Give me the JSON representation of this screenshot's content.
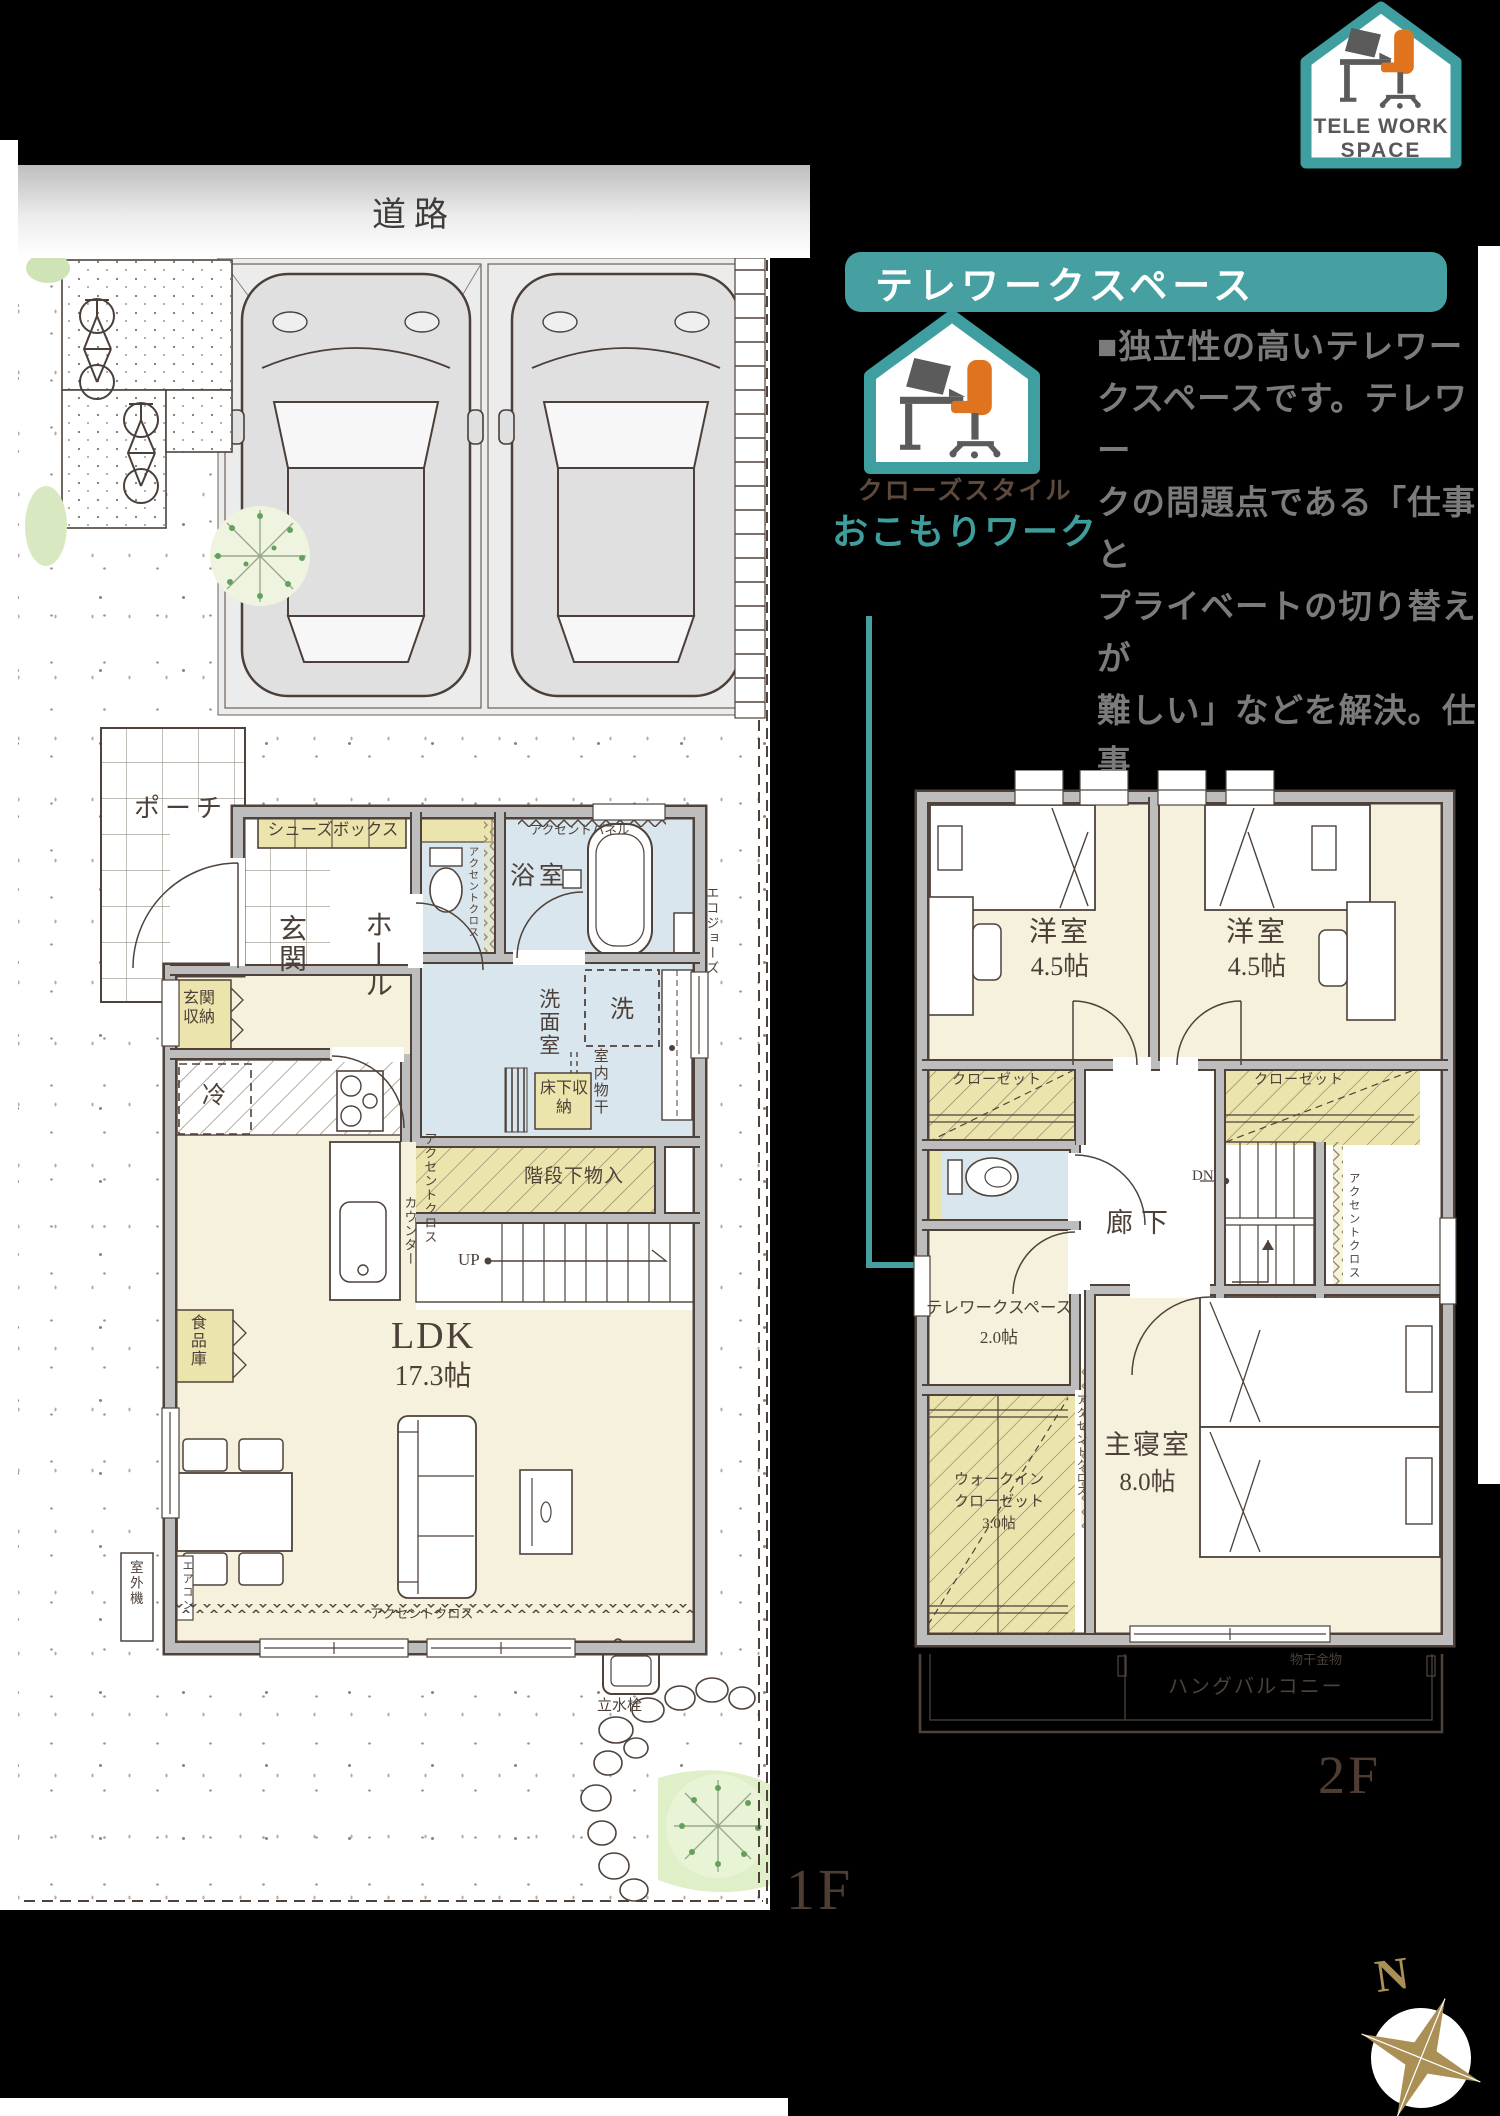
{
  "logo_badge": {
    "line1": "TELE WORK",
    "line2": "SPACE"
  },
  "road": {
    "label": "道路"
  },
  "feature": {
    "banner_title": "テレワークスペース",
    "style_tag": "クローズスタイル",
    "style_name": "おこもりワーク",
    "description": "■独立性の高いテレワー\nクスペースです。テレワー\nクの問題点である「仕事と\nプライベートの切り替えが\n難しい」などを解決。仕事\nにじっくり取り組めます。"
  },
  "floor1": {
    "floor_label": "1F",
    "labels": {
      "porch": "ポーチ",
      "shoes_box": "シューズボックス",
      "entrance": "玄関",
      "hall": "ホール",
      "entrance_storage": "玄関収納",
      "accent_cloth_toilet": "アクセントクロス",
      "bathroom": "浴室",
      "accent_panel": "アクセントパネル",
      "washroom": "洗面室",
      "washer": "洗",
      "indoor_drying": "室内物干",
      "underfloor_storage": "床下収納",
      "fridge": "冷",
      "accent_cloth_kitchen": "アクセントクロス",
      "counter": "カウンター",
      "under_stairs_storage": "階段下物入",
      "up": "UP",
      "ldk_name": "LDK",
      "ldk_size": "17.3帖",
      "pantry": "食品庫",
      "aircon": "エアコン",
      "outdoor_unit": "室外機",
      "accent_cloth_living": "アクセントクロス",
      "water_tap": "立水栓",
      "eco_jozu": "エコジョーズ"
    }
  },
  "floor2": {
    "floor_label": "2F",
    "labels": {
      "bedroom_left_name": "洋室",
      "bedroom_left_size": "4.5帖",
      "bedroom_right_name": "洋室",
      "bedroom_right_size": "4.5帖",
      "closet_left": "クローゼット",
      "closet_right": "クローゼット",
      "hallway": "廊下",
      "down": "DN",
      "accent_cloth_stairs": "アクセントクロス",
      "telework_name": "テレワークスペース",
      "telework_size": "2.0帖",
      "wic_line1": "ウォークイン",
      "wic_line2": "クローゼット",
      "wic_size": "3.0帖",
      "master_name": "主寝室",
      "master_size": "8.0帖",
      "accent_cloth_master": "アクセントクロス",
      "drying_fixture": "物干金物",
      "balcony": "ハングバルコニー"
    }
  },
  "compass": {
    "north": "N"
  },
  "colors": {
    "teal": "#46a0a1",
    "orange": "#e0731d",
    "gold": "#ab9055",
    "cream": "#f5f1dc",
    "wet_blue": "#d9e6ee",
    "closet_yellow": "#ece4ad"
  }
}
